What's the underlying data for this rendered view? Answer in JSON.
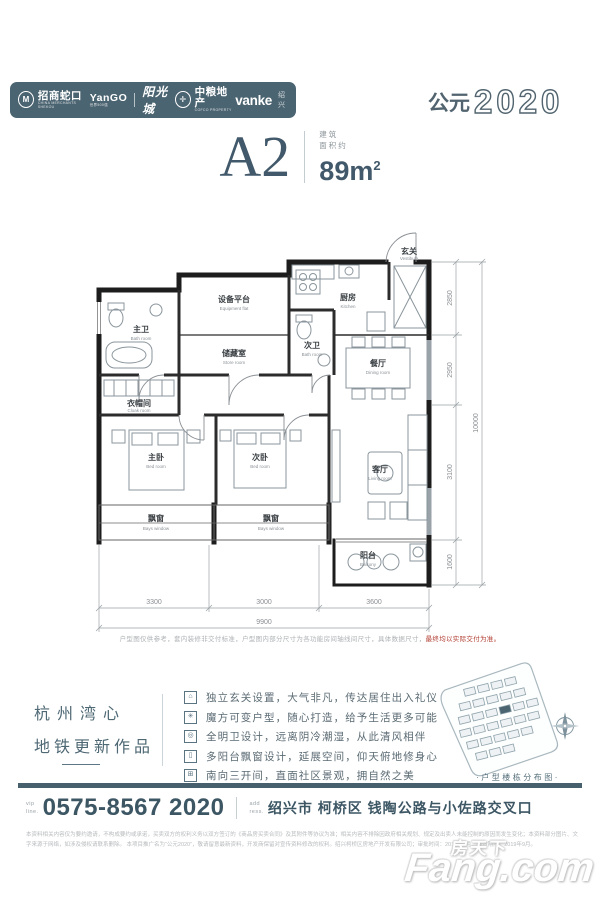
{
  "header": {
    "brands": [
      {
        "icon_letter": "M",
        "name": "招商蛇口",
        "caption": "CHINA MERCHANTS SHEKOU"
      },
      {
        "name": "YanGO",
        "caption": "世界500强",
        "script": "阳光城"
      },
      {
        "icon_letter": "",
        "name": "中粮地产",
        "caption": "COFCO PROPERTY"
      },
      {
        "name": "vanke",
        "suffix": "绍兴"
      }
    ],
    "year_prefix": "公元",
    "year_digits": "2020"
  },
  "title": {
    "plan_name": "A2",
    "area_cap_1": "建筑",
    "area_cap_2": "面积约",
    "area_value": "89m",
    "area_sup": "2"
  },
  "plan": {
    "rooms": [
      {
        "cn": "设备平台",
        "en": "Equipment flat"
      },
      {
        "cn": "储藏室",
        "en": "Store room"
      },
      {
        "cn": "主卫",
        "en": "Bath room"
      },
      {
        "cn": "次卫",
        "en": "Bath room"
      },
      {
        "cn": "厨房",
        "en": "Kitchen"
      },
      {
        "cn": "玄关",
        "en": "Vestibule"
      },
      {
        "cn": "衣帽间",
        "en": "Cloak room"
      },
      {
        "cn": "餐厅",
        "en": "Dining room"
      },
      {
        "cn": "主卧",
        "en": "Bed room"
      },
      {
        "cn": "次卧",
        "en": "Bed room"
      },
      {
        "cn": "客厅",
        "en": "Living room"
      },
      {
        "cn": "阳台",
        "en": "Balcony"
      },
      {
        "cn": "飘窗",
        "en": "Bays window"
      },
      {
        "cn": "飘窗",
        "en": "Bays window"
      }
    ],
    "dims_bottom": [
      "3300",
      "3000",
      "3600"
    ],
    "dim_bottom_total": "9900",
    "dims_right": [
      "2850",
      "2950",
      "3100",
      "1600"
    ],
    "dim_right_total": "10000",
    "note_gray": "户型图仅供参考，套内装修非交付标准，户型图内部分尺寸为各功能房间轴线间尺寸，具体数据尺寸，",
    "note_red": "最终均以实际交付为准。"
  },
  "slogan": {
    "line1": "杭州湾心",
    "line2": "地铁更新作品"
  },
  "features": [
    {
      "icon": "⌂",
      "text": "独立玄关设置，大气非凡，传达居住出入礼仪"
    },
    {
      "icon": "✳",
      "text": "魔方可变户型，随心打造，给予生活更多可能"
    },
    {
      "icon": "◎",
      "text": "全明卫设计，远离阴冷潮湿，从此清风相伴"
    },
    {
      "icon": "▯",
      "text": "多阳台飘窗设计，延展空间，仰天俯地修身心"
    },
    {
      "icon": "⊞",
      "text": "南向三开间，直面社区景观，拥自然之美"
    }
  ],
  "diagram": {
    "label": "·户型楼栋分布图·"
  },
  "contact": {
    "phone_pfx_1": "vip",
    "phone_pfx_2": "line.",
    "phone": "0575-8567 2020",
    "addr_pfx_1": "add",
    "addr_pfx_2": "ress.",
    "address": "绍兴市 柯桥区 钱陶公路与小佐路交叉口"
  },
  "legal": {
    "line1": "本资料相关内容仅为要约邀请，不构成要约或承诺，买卖双方的权利义务以双方签订的《商品房买卖合同》及其附件等协议为准；相关内容不排除因政府相关规划、规定及出卖人未能控制的原因而发生变化；本资料部分图片、文字来源于网络，如涉及侵权请联系删除。",
    "line2": "本项目推广名为“公元2020”，敬请留意最新资料，开发商保留对宣传资料修改的权利。绍兴柯桥区房地产开发有限公司；审批时间：2019年6月；有效期限：2019年9月。"
  },
  "watermark": {
    "cn": "房天下",
    "en": "Fang.com"
  }
}
